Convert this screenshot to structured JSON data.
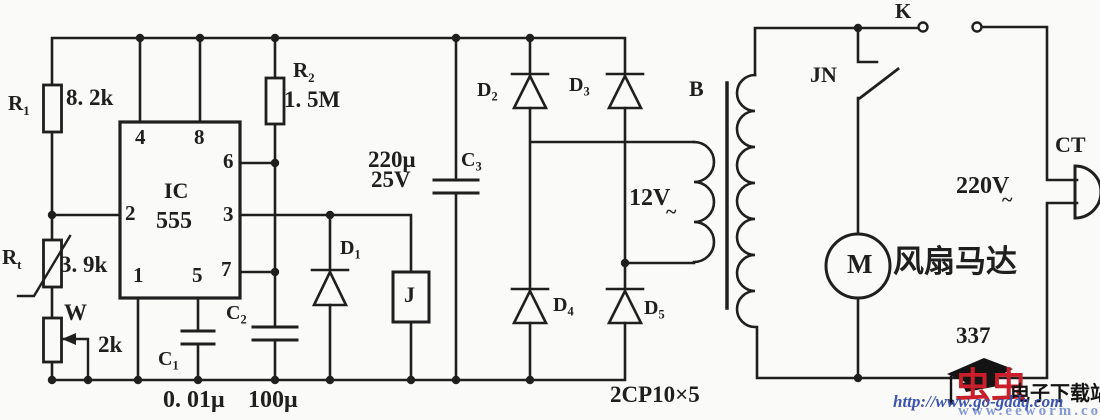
{
  "doc": {
    "page_number": "337",
    "diode_model": "2CP10×5"
  },
  "colors": {
    "ink": "#1f1f1f",
    "paper": "#fafaf8",
    "watermark_red": "#c91f2a",
    "watermark_blue": "#3d55ae",
    "watermark_black": "#141414"
  },
  "timer": {
    "label": "IC",
    "model": "555",
    "pins": {
      "p1": "1",
      "p2": "2",
      "p3": "3",
      "p4": "4",
      "p5": "5",
      "p6": "6",
      "p7": "7",
      "p8": "8"
    }
  },
  "components": {
    "r1": {
      "base": "R",
      "sub": "1",
      "value": "8. 2k"
    },
    "rt": {
      "base": "R",
      "sub": "t",
      "value": "3. 9k"
    },
    "w": {
      "label": "W",
      "value": "2k"
    },
    "r2": {
      "base": "R",
      "sub": "2",
      "value": "1. 5M"
    },
    "c1": {
      "base": "C",
      "sub": "1",
      "value": "0. 01μ"
    },
    "c2": {
      "base": "C",
      "sub": "2",
      "value": "100μ"
    },
    "c3": {
      "base": "C",
      "sub": "3",
      "value": "220μ",
      "voltage": "25V"
    },
    "d1": {
      "base": "D",
      "sub": "1"
    },
    "d2": {
      "base": "D",
      "sub": "2"
    },
    "d3": {
      "base": "D",
      "sub": "3"
    },
    "d4": {
      "base": "D",
      "sub": "4"
    },
    "d5": {
      "base": "D",
      "sub": "5"
    },
    "relay_coil": {
      "label": "J"
    },
    "transformer": {
      "label": "B",
      "secondary_voltage": "12V",
      "ac_symbol": "~"
    },
    "switch_k": {
      "label": "K"
    },
    "relay_contact": {
      "label": "JN"
    },
    "motor": {
      "symbol": "M",
      "label": "风扇马达"
    },
    "mains": {
      "voltage": "220V",
      "ac_symbol": "~"
    },
    "plug": {
      "label": "CT"
    }
  },
  "watermark": {
    "logo_chars": "虫虫",
    "site_name": "电子下载站",
    "url_primary": "http://www.go-gddq.com",
    "url_secondary": "www.eeworm.com"
  }
}
